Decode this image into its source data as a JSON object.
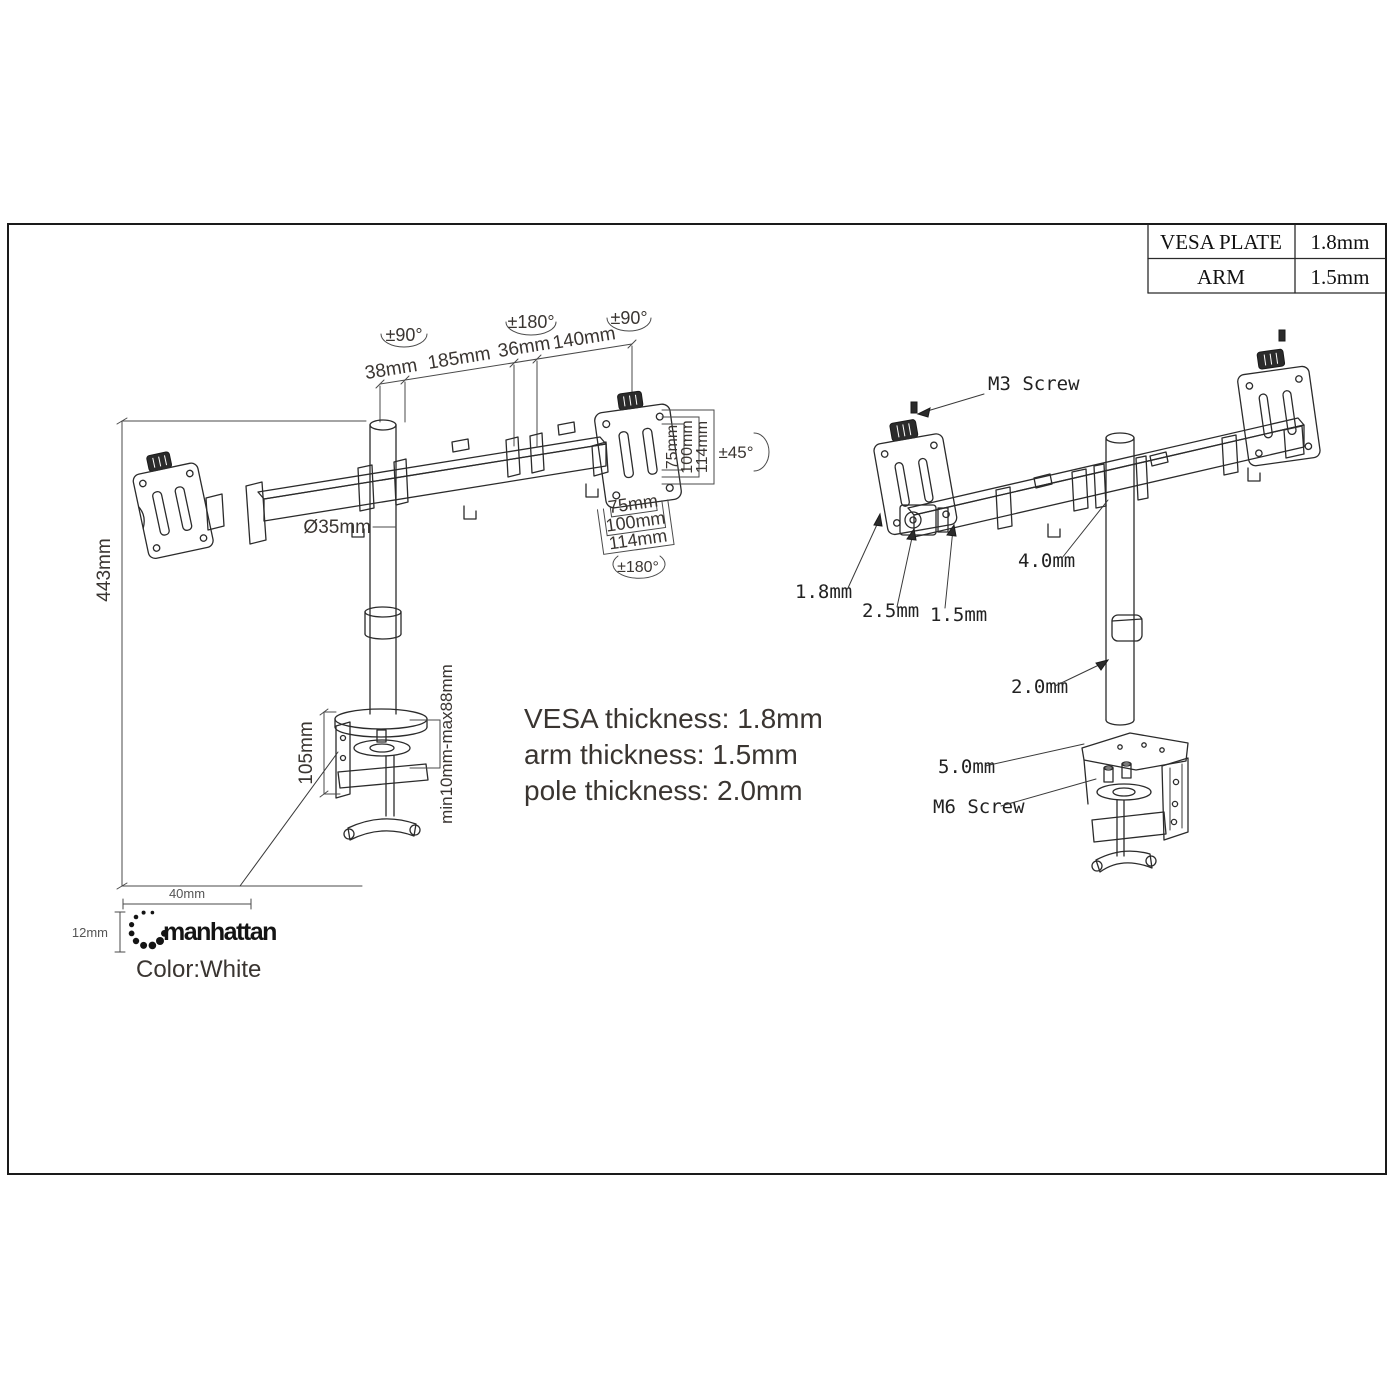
{
  "spec_table": {
    "rows": [
      {
        "label": "VESA PLATE",
        "value": "1.8mm"
      },
      {
        "label": "ARM",
        "value": "1.5mm"
      }
    ]
  },
  "left_view": {
    "angles": {
      "left_swivel": "±90°",
      "mid_swivel": "±180°",
      "right_swivel": "±90°",
      "tilt": "±45°",
      "rotation": "±180°"
    },
    "top_dims": {
      "seg1": "38mm",
      "seg2": "185mm",
      "seg3": "36mm",
      "seg4": "140mm"
    },
    "height_dim": "443mm",
    "pole_diameter": "Ø35mm",
    "clamp_height": "105mm",
    "desk_range": "min10mm-max88mm",
    "vesa_vertical": {
      "v75": "75mm",
      "v100": "100mm",
      "v114": "114mm"
    },
    "vesa_horizontal": {
      "h75": "75mm",
      "h100": "100mm",
      "h114": "114mm"
    }
  },
  "notes": {
    "line1": "VESA thickness: 1.8mm",
    "line2": "arm thickness: 1.5mm",
    "line3": "pole thickness: 2.0mm"
  },
  "exploded_view": {
    "labels": {
      "m3_screw": "M3 Screw",
      "vesa_thickness": "1.8mm",
      "bracket_thickness": "2.5mm",
      "arm_thickness": "1.5mm",
      "joint_thickness": "4.0mm",
      "pole_thickness": "2.0mm",
      "clamp_plate_thickness": "5.0mm",
      "m6_screw": "M6 Screw"
    }
  },
  "branding": {
    "name": "manhattan",
    "logo_width": "40mm",
    "logo_height": "12mm",
    "color_note": "Color:White"
  }
}
